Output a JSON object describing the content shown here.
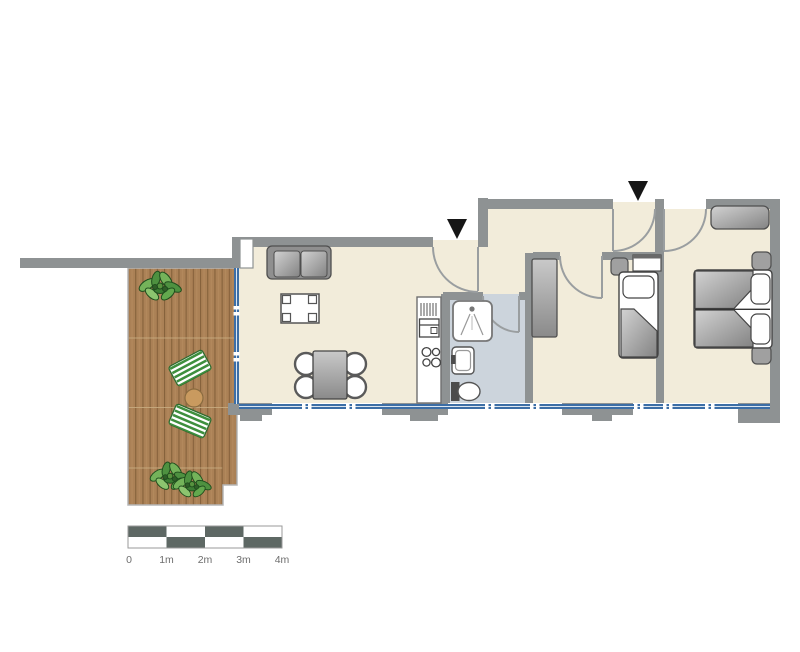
{
  "scale_bar": {
    "labels": [
      "0",
      "1m",
      "2m",
      "3m",
      "4m"
    ]
  },
  "colors": {
    "background": "#ffffff",
    "wall": "#8e9293",
    "floor": "#f2ecda",
    "bathroom_floor": "#ccd4dc",
    "deck_wood": "#ab8156",
    "deck_plank_line": "#85613b",
    "window": "#3c6ea6",
    "scale_dark": "#5e6864",
    "scale_light": "#ffffff",
    "label_text": "#6e6e6e",
    "entrance_arrow": "#161616",
    "furniture_stroke": "#4f4f4f",
    "furniture_light": "#d2d2d2",
    "furniture_dark": "#838383",
    "plant_green": "#5d9c46",
    "lounger_green": "#3e8f3e",
    "side_table_wood": "#c99a5f",
    "toilet_tank": "#4c4c4c"
  },
  "icons": {
    "entrance_marker": "filled-down-triangle",
    "furniture": [
      "sofa",
      "coffee-table",
      "dining-table",
      "dining-chair",
      "kitchen-counter",
      "hob",
      "fridge",
      "shower",
      "washbasin",
      "toilet",
      "wardrobe",
      "single-bed",
      "double-bed",
      "nightstand",
      "dresser",
      "shelf",
      "plant",
      "sun-lounger",
      "side-table"
    ]
  }
}
